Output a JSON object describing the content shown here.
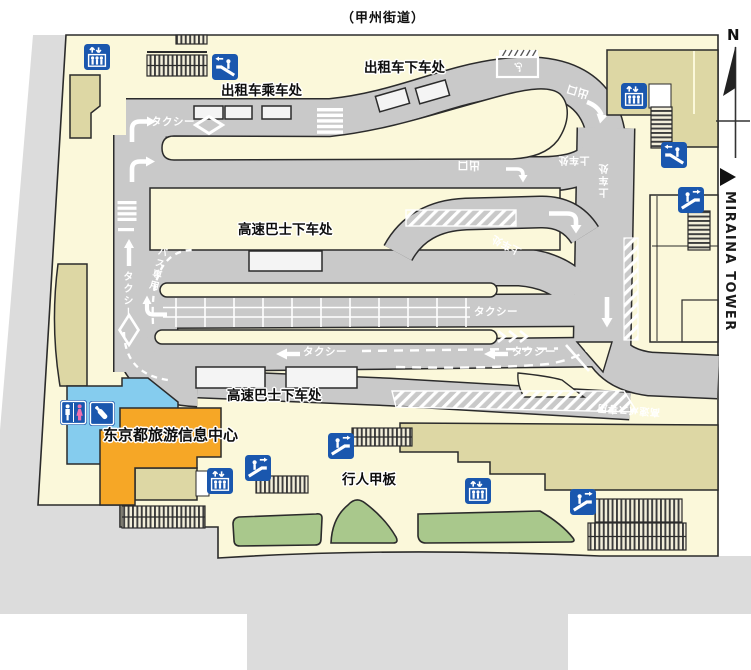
{
  "street_title": "（甲州街道）",
  "compass_n": "N",
  "accessible_sign": "♿",
  "miraina": {
    "label": "MIRAINA TOWER"
  },
  "colors": {
    "road": "#c9c9c9",
    "deck": "#fbf8da",
    "street": "#dcdcdc",
    "building": "#ddd7a4",
    "icon_blue": "#1a57ae",
    "toilet_blue": "#85ccee",
    "info_orange": "#f6a726",
    "planter": "#a9c88c",
    "pink": "#ee6fae",
    "outline": "#2b2b2b"
  },
  "area_labels": [
    {
      "id": "taxi-dropoff",
      "text": "出租车下车处",
      "x": 364,
      "y": 62
    },
    {
      "id": "taxi-pickup",
      "text": "出租车乘车处",
      "x": 221,
      "y": 85
    },
    {
      "id": "bus-dropoff-top",
      "text": "高速巴士下车处",
      "x": 238,
      "y": 224
    },
    {
      "id": "bus-dropoff-bottom",
      "text": "高速巴士下车处",
      "x": 227,
      "y": 390
    },
    {
      "id": "info-center",
      "text": "东京都旅游信息中心",
      "x": 103,
      "y": 428,
      "size": 15
    },
    {
      "id": "pedestrian-deck",
      "text": "行人甲板",
      "x": 342,
      "y": 474
    }
  ],
  "road_texts": [
    {
      "id": "taxi-top",
      "text": "タクシー",
      "x": 151,
      "y": 117
    },
    {
      "id": "taxi-left-vert",
      "text": "タクシー",
      "x": 121,
      "y": 271,
      "vertical": true,
      "size": 10
    },
    {
      "id": "bus-lane",
      "text": "バス専用",
      "x": 152,
      "y": 246,
      "vertical": true,
      "rot": 14,
      "size": 9.5
    },
    {
      "id": "taxi-mid",
      "text": "タクシー",
      "x": 474,
      "y": 307
    },
    {
      "id": "taxi-west-1",
      "text": "タクシー",
      "x": 303,
      "y": 347
    },
    {
      "id": "taxi-west-2",
      "text": "タクシー",
      "x": 512,
      "y": 347
    },
    {
      "id": "exit-curve",
      "text": "出口",
      "x": 566,
      "y": 86,
      "rot": 197,
      "size": 11
    },
    {
      "id": "exit-inner",
      "text": "出口",
      "x": 457,
      "y": 160,
      "rot": 180,
      "size": 11
    },
    {
      "id": "boarding-h",
      "text": "上车处",
      "x": 558,
      "y": 154,
      "rot": 180,
      "size": 10
    },
    {
      "id": "boarding-v",
      "text": "上车处",
      "x": 601,
      "y": 162,
      "rot": 180,
      "vertical": true,
      "size": 10
    },
    {
      "id": "boarding-diag",
      "text": "上车处",
      "x": 491,
      "y": 239,
      "rot": 207,
      "size": 10
    },
    {
      "id": "bus-only-exit",
      "text": "高速バス専用",
      "x": 597,
      "y": 404,
      "rot": 184,
      "size": 10
    }
  ],
  "icons": [
    {
      "type": "elevator",
      "x": 84,
      "y": 44
    },
    {
      "type": "escalator",
      "x": 212,
      "y": 54,
      "flip": true
    },
    {
      "type": "elevator",
      "x": 621,
      "y": 83
    },
    {
      "type": "escalator",
      "x": 661,
      "y": 142,
      "flip": true
    },
    {
      "type": "escalator",
      "x": 678,
      "y": 187
    },
    {
      "type": "toilet",
      "x": 60,
      "y": 400
    },
    {
      "type": "nursing",
      "x": 89,
      "y": 401
    },
    {
      "type": "elevator",
      "x": 207,
      "y": 468
    },
    {
      "type": "escalator",
      "x": 245,
      "y": 455
    },
    {
      "type": "escalator",
      "x": 328,
      "y": 433
    },
    {
      "type": "elevator",
      "x": 465,
      "y": 478
    },
    {
      "type": "escalator",
      "x": 570,
      "y": 489
    }
  ]
}
